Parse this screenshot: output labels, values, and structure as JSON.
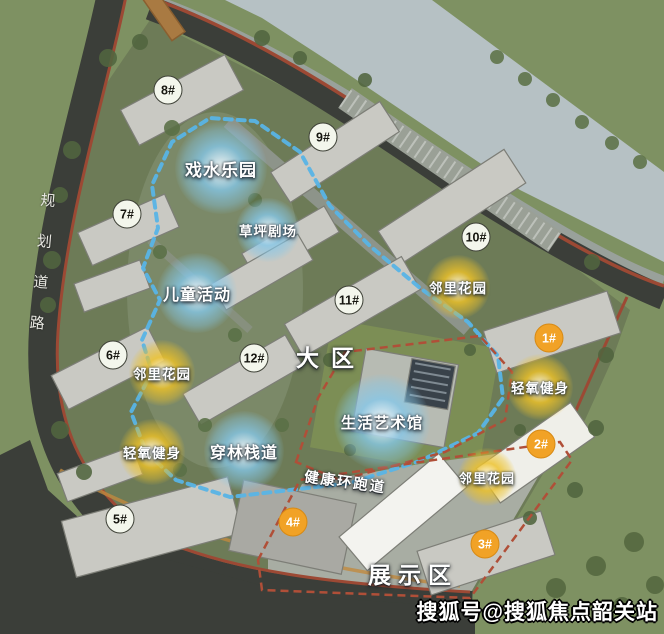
{
  "labels": {
    "main_area": "大区",
    "display_area": "展示区",
    "running_track": "健康环跑道",
    "planning_road": "规划道路"
  },
  "watermark": "搜狐号@搜狐焦点韶关站",
  "markers": {
    "buildings": [
      {
        "label": "8#",
        "x": 168,
        "y": 90,
        "style": "white"
      },
      {
        "label": "9#",
        "x": 323,
        "y": 137,
        "style": "white"
      },
      {
        "label": "7#",
        "x": 127,
        "y": 214,
        "style": "white"
      },
      {
        "label": "10#",
        "x": 476,
        "y": 237,
        "style": "white"
      },
      {
        "label": "11#",
        "x": 349,
        "y": 300,
        "style": "white"
      },
      {
        "label": "6#",
        "x": 113,
        "y": 355,
        "style": "white"
      },
      {
        "label": "12#",
        "x": 254,
        "y": 358,
        "style": "white"
      },
      {
        "label": "5#",
        "x": 120,
        "y": 519,
        "style": "white"
      },
      {
        "label": "1#",
        "x": 549,
        "y": 338,
        "style": "orange"
      },
      {
        "label": "2#",
        "x": 541,
        "y": 444,
        "style": "orange"
      },
      {
        "label": "3#",
        "x": 485,
        "y": 544,
        "style": "orange"
      },
      {
        "label": "4#",
        "x": 293,
        "y": 522,
        "style": "orange"
      }
    ],
    "features": [
      {
        "label": "戏水乐园",
        "x": 221,
        "y": 168,
        "r": 46,
        "color": "blue",
        "font": 17
      },
      {
        "label": "草坪剧场",
        "x": 268,
        "y": 230,
        "r": 32,
        "color": "blue",
        "font": 13.5
      },
      {
        "label": "儿童活动",
        "x": 197,
        "y": 293,
        "r": 40,
        "color": "blue",
        "font": 16
      },
      {
        "label": "穿林栈道",
        "x": 244,
        "y": 451,
        "r": 40,
        "color": "blue",
        "font": 16
      },
      {
        "label": "生活艺术馆",
        "x": 382,
        "y": 422,
        "r": 48,
        "color": "blue",
        "font": 15.5
      },
      {
        "label": "邻里花园",
        "x": 162,
        "y": 373,
        "r": 33,
        "color": "yellow",
        "font": 13.5
      },
      {
        "label": "邻里花园",
        "x": 458,
        "y": 287,
        "r": 32,
        "color": "yellow",
        "font": 13.5
      },
      {
        "label": "邻里花园",
        "x": 487,
        "y": 477,
        "r": 29,
        "color": "yellow",
        "font": 13
      },
      {
        "label": "轻氧健身",
        "x": 152,
        "y": 452,
        "r": 33,
        "color": "yellow",
        "font": 13.5
      },
      {
        "label": "轻氧健身",
        "x": 540,
        "y": 387,
        "r": 33,
        "color": "yellow",
        "font": 13.5
      }
    ]
  },
  "colors": {
    "feature_blue": "#85c8ea",
    "feature_yellow": "#eec228",
    "marker_orange": "#f1a226",
    "marker_white_bg": "#f3f6ec",
    "track_blue": "#58b4e6",
    "boundary_red": "#b04f38",
    "river": "#b6c1c4",
    "road": "#3b3e39",
    "grass": "#7e9162"
  }
}
